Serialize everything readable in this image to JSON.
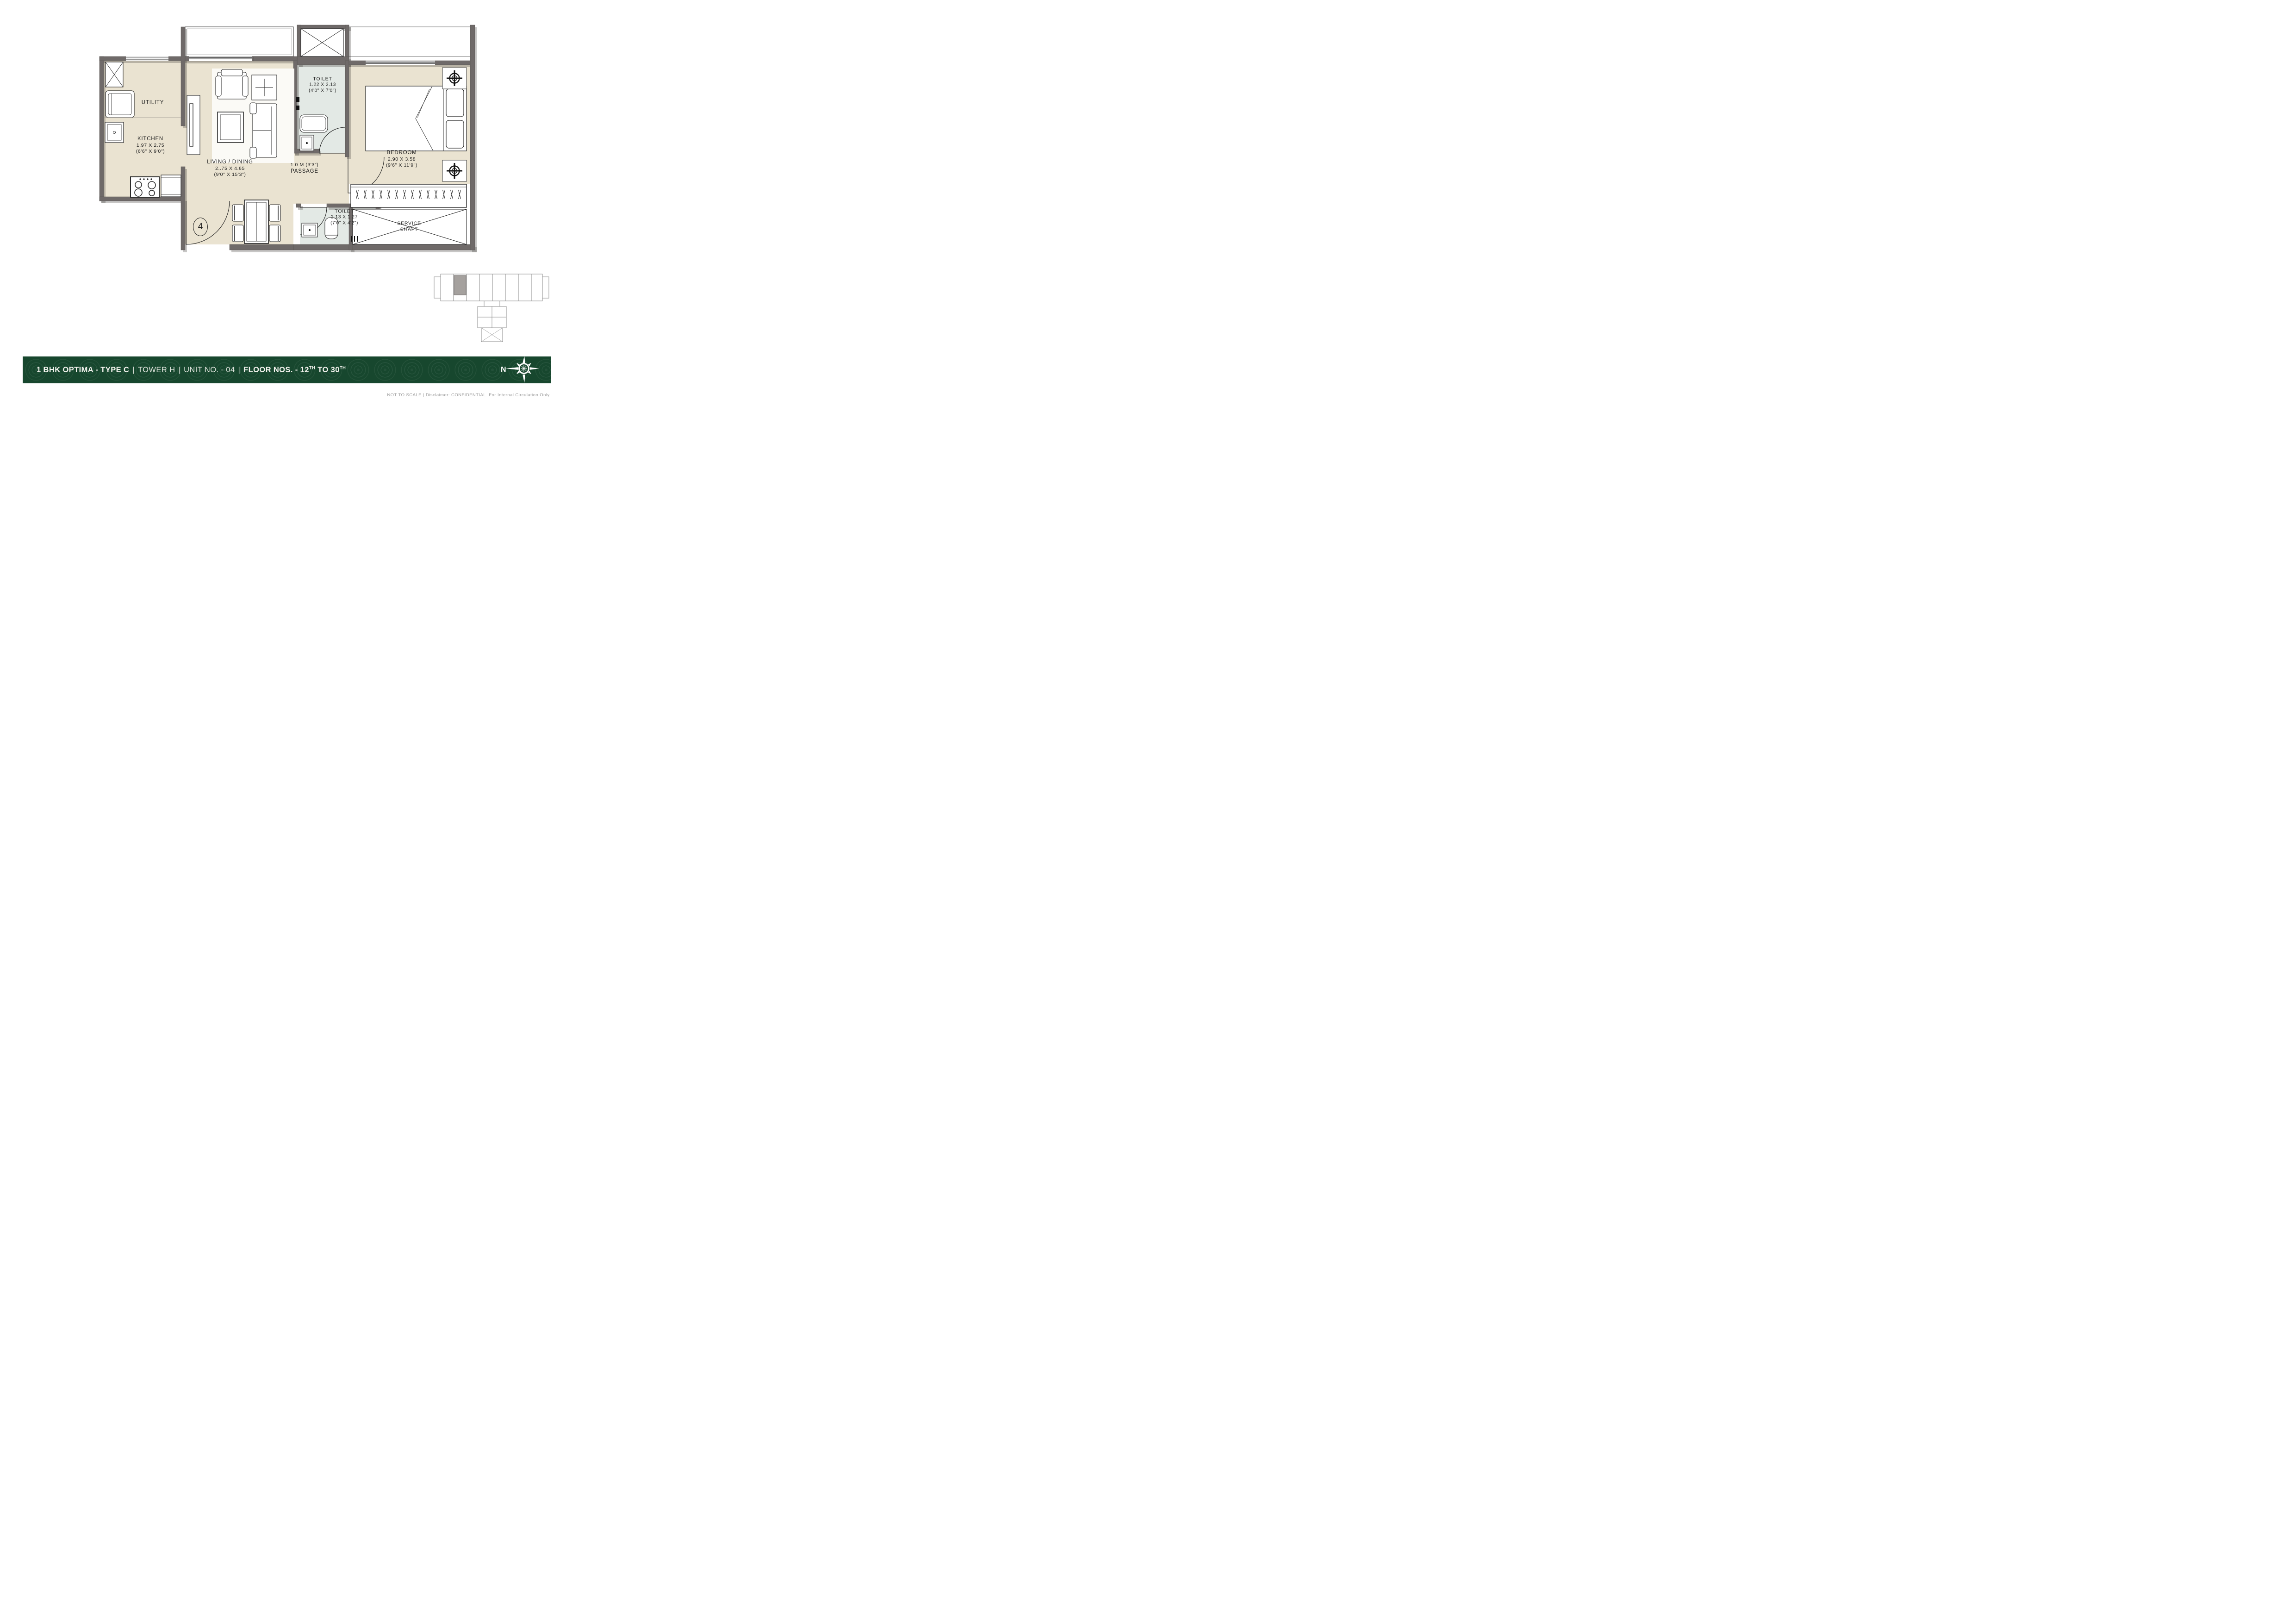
{
  "rooms": {
    "utility": {
      "name": "UTILITY"
    },
    "kitchen": {
      "name": "KITCHEN",
      "dim_m": "1.97 X 2.75",
      "dim_ft": "(6'6\" X 9'0\")"
    },
    "living": {
      "name": "LIVING / DINING",
      "dim_m": "2..75 X 4.65",
      "dim_ft": "(9'0\" X 15'3\")"
    },
    "toilet1": {
      "name": "TOILET",
      "dim_m": "1.22 X 2.13",
      "dim_ft": "(4'0\" X 7'0\")"
    },
    "passage": {
      "line1": "1.0 M (3'3\")",
      "line2": "PASSAGE"
    },
    "bedroom": {
      "name": "BEDROOM",
      "dim_m": "2.90 X 3.58",
      "dim_ft": "(9'6\" X 11'9\")"
    },
    "toilet2": {
      "name": "TOILET",
      "dim_m": "2.13 X 1.27",
      "dim_ft": "(7'0\" X 4'2\")"
    },
    "service_shaft": {
      "line1": "SERVICE",
      "line2": "SHAFT"
    }
  },
  "entrance": {
    "unit_number": "4"
  },
  "footer": {
    "part1": "1 BHK OPTIMA - TYPE C",
    "sep": "|",
    "tower": "TOWER H",
    "unit": "UNIT NO. - 04",
    "floors_a": "FLOOR NOS. - 12",
    "floors_sup": "TH",
    "floors_b": " TO 30",
    "compass_n": "N"
  },
  "disclaimer": "NOT TO SCALE | Disclaimer: CONFIDENTIAL. For Internal Circulation Only.",
  "colors": {
    "footer_green": "#17472e",
    "wall_gray": "#6f6a69",
    "floor_beige": "#eae3d1",
    "toilet_floor": "#e3e9e5",
    "keyplan_highlight": "#a5a19e"
  }
}
